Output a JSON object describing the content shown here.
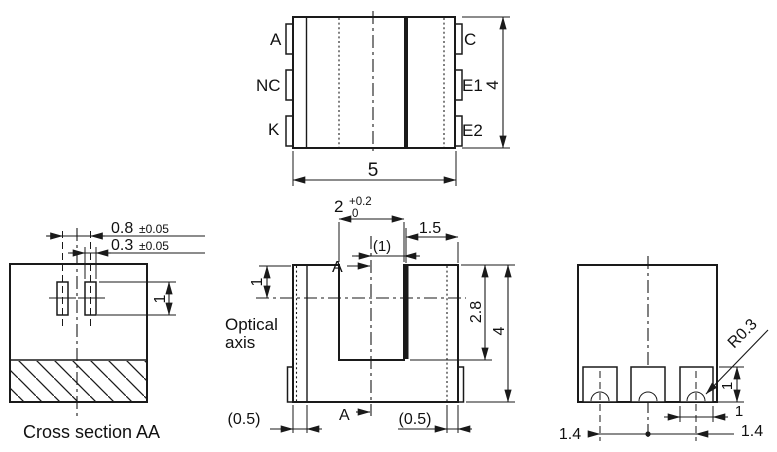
{
  "drawing": {
    "title_hint": "Photointerrupter package outline drawing",
    "colors": {
      "line": "#1a1a1a",
      "background": "#ffffff"
    },
    "top_view": {
      "left_pins": [
        "A",
        "NC",
        "K"
      ],
      "right_pins": [
        "C",
        "E1",
        "E2"
      ],
      "dim_width": "5",
      "dim_height": "4"
    },
    "cross_section": {
      "caption": "Cross section AA",
      "dim_pitch": "0.8",
      "dim_pitch_tol": "±0.05",
      "dim_aperture": "0.3",
      "dim_aperture_tol": "±0.05",
      "dim_aperture_height": "1"
    },
    "front_view": {
      "optical_axis_label_line1": "Optical",
      "optical_axis_label_line2": "axis",
      "section_marker": "A",
      "dim_slot_width": "2",
      "dim_slot_width_tol_upper": "+0.2",
      "dim_slot_width_tol_lower": "0",
      "dim_top_right": "1.5",
      "dim_center_to_wall": "(1)",
      "dim_top_step": "1",
      "dim_slot_depth": "2.8",
      "dim_height": "4",
      "dim_wall_left": "(0.5)",
      "dim_wall_right": "(0.5)"
    },
    "side_view": {
      "dim_notch_radius": "R0.3",
      "dim_pad_height": "1",
      "dim_pad_width": "1",
      "dim_pad_pitch_left": "1.4",
      "dim_pad_pitch_right": "1.4"
    }
  }
}
